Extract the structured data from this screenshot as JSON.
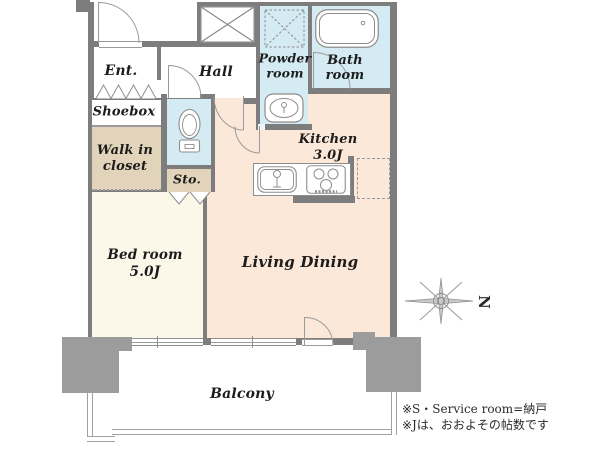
{
  "title": "apartment-floor-plan",
  "rooms": {
    "ent": {
      "label": "Ent."
    },
    "hall": {
      "label": "Hall"
    },
    "powder_room": {
      "line1": "Powder",
      "line2": "room"
    },
    "bath_room": {
      "line1": "Bath",
      "line2": "room"
    },
    "shoebox": {
      "label": "Shoebox"
    },
    "walk_in_closet": {
      "line1": "Walk in",
      "line2": "closet"
    },
    "storage": {
      "label": "Sto."
    },
    "kitchen": {
      "label": "Kitchen",
      "size": "3.0J"
    },
    "bedroom": {
      "label": "Bed room",
      "size": "5.0J"
    },
    "living_dining": {
      "label": "Living Dining"
    },
    "balcony": {
      "label": "Balcony"
    }
  },
  "compass": {
    "north_label": "N"
  },
  "notes": {
    "line1": "※S・Service room=納戸",
    "line2": "※Jは、おおよその帖数です"
  },
  "colors": {
    "wall": "#7d7d7d",
    "pillar": "#9c9c9c",
    "wet_area": "#d4ebf3",
    "living_kitchen": "#fbe8d8",
    "bedroom": "#fcf8e9",
    "closet": "#e2d4ba",
    "balcony_line": "#a0a0a0",
    "text": "#1c1c1c"
  },
  "icons": [
    "bathtub-icon",
    "washing-machine-icon",
    "washbasin-icon",
    "toilet-icon",
    "kitchen-sink-icon",
    "gas-stove-icon",
    "refrigerator-space",
    "closet-cross-icon",
    "folding-door-icon",
    "swing-door-icon",
    "sliding-window",
    "compass-star-icon"
  ]
}
